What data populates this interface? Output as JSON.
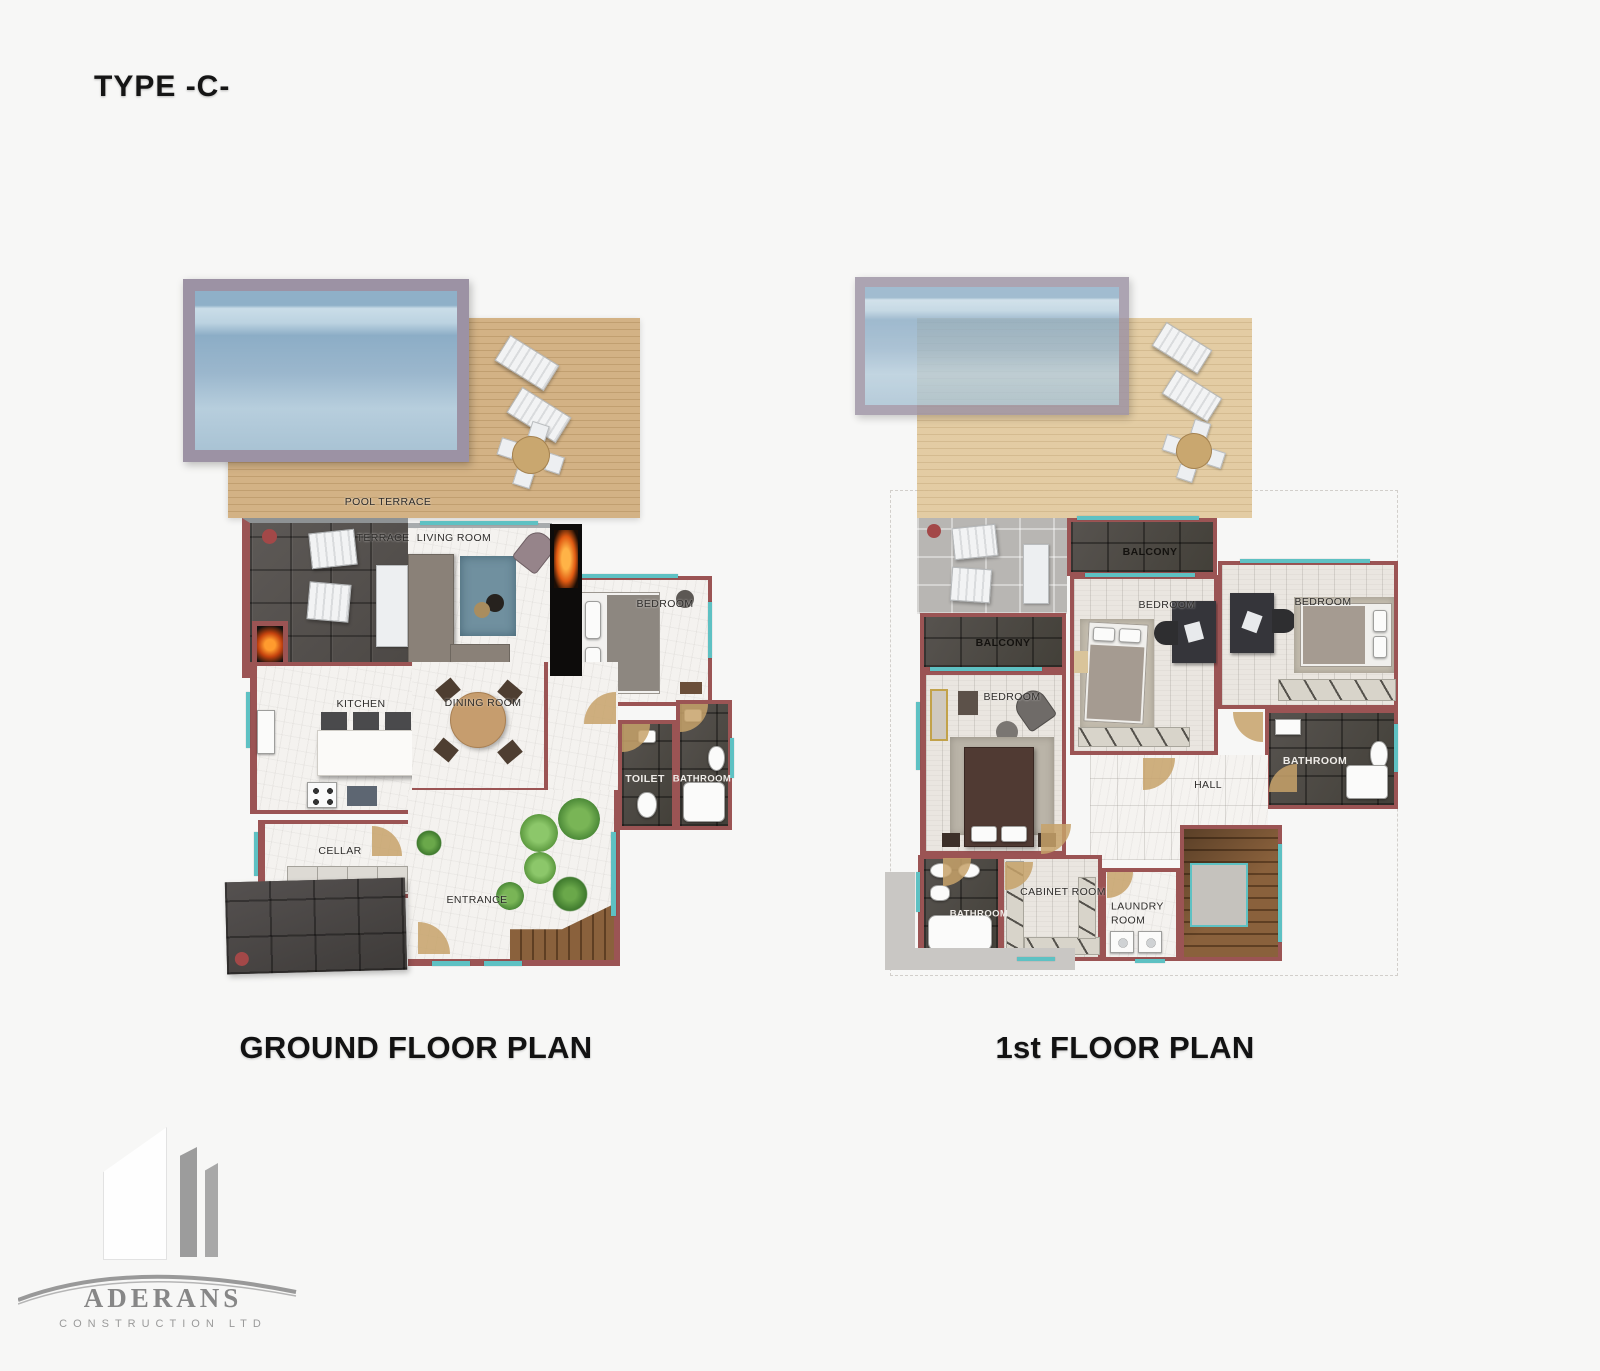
{
  "header": {
    "type_label": "TYPE -C-"
  },
  "ground_floor": {
    "title": "GROUND FLOOR PLAN",
    "labels": {
      "pool_terrace": "POOL TERRACE",
      "terrace": "TERRACE",
      "living_room": "LIVING ROOM",
      "bedroom": "BEDROOM",
      "kitchen": "KITCHEN",
      "dining_room": "DINING ROOM",
      "toilet": "TOILET",
      "bathroom": "BATHROOM",
      "cellar": "CELLAR",
      "entrance": "ENTRANCE"
    }
  },
  "first_floor": {
    "title": "1st FLOOR PLAN",
    "labels": {
      "balcony_top": "BALCONY",
      "balcony_left": "BALCONY",
      "bedroom_left": "BEDROOM",
      "bedroom_middle": "BEDROOM",
      "bedroom_right": "BEDROOM",
      "hall": "HALL",
      "bathroom_right": "BATHROOM",
      "bathroom_left": "BATHROOM",
      "cabinet_room": "CABINET ROOM",
      "laundry_room": "LAUNDRY ROOM"
    }
  },
  "logo": {
    "company": "ADERANS",
    "subtitle": "CONSTRUCTION LTD"
  },
  "colors": {
    "background": "#f7f7f6",
    "wall": "#9b5454",
    "wood_deck": "#cdab7d",
    "dark_stone": "#56524f",
    "marble": "#f4f2ef",
    "pool_water": "#93b3ca",
    "pool_frame": "#9c92a4",
    "window_teal": "#5ec1c3",
    "door_tan": "#c7a26a",
    "stair_wood": "#7d5634"
  }
}
